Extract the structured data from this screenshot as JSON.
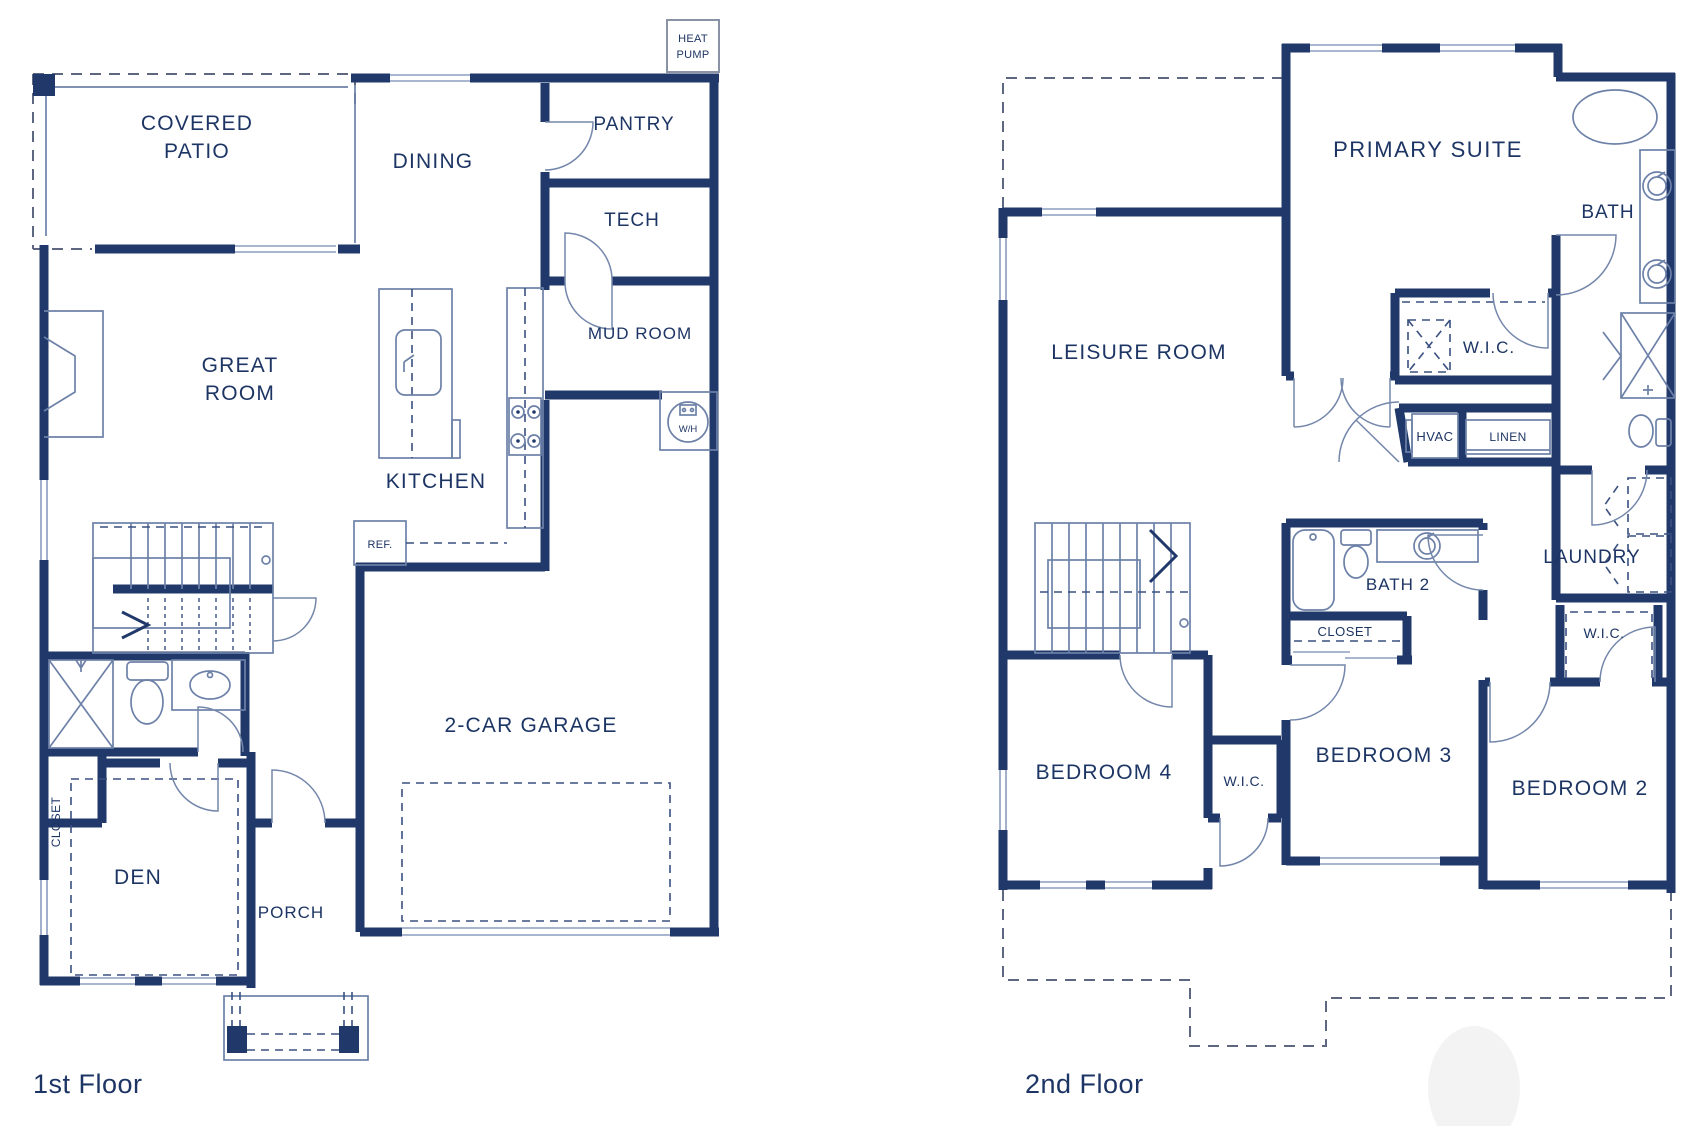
{
  "colors": {
    "wall": "#21396a",
    "text": "#1d3564",
    "thin_line": "#6d81a8",
    "window_line": "#8b9dc0",
    "dashed_outline": "#5d6880",
    "background": "#ffffff"
  },
  "floor1": {
    "name": "1st Floor",
    "rooms": {
      "covered_patio_1": "COVERED",
      "covered_patio_2": "PATIO",
      "dining": "DINING",
      "pantry": "PANTRY",
      "tech": "TECH",
      "mud_room": "MUD ROOM",
      "great_room_1": "GREAT",
      "great_room_2": "ROOM",
      "kitchen": "KITCHEN",
      "garage": "2-CAR GARAGE",
      "den": "DEN",
      "porch": "PORCH",
      "closet": "CLOSET"
    },
    "equipment": {
      "heat_pump_1": "HEAT",
      "heat_pump_2": "PUMP",
      "ref": "REF.",
      "water_heater": "W/H"
    }
  },
  "floor2": {
    "name": "2nd Floor",
    "rooms": {
      "primary_suite": "PRIMARY SUITE",
      "bath": "BATH",
      "leisure_room": "LEISURE ROOM",
      "wic_primary": "W.I.C.",
      "hvac": "HVAC",
      "linen": "LINEN",
      "laundry": "LAUNDRY",
      "bath2": "BATH 2",
      "closet": "CLOSET",
      "wic_bedroom2": "W.I.C.",
      "bedroom4": "BEDROOM 4",
      "wic_bedroom4": "W.I.C.",
      "bedroom3": "BEDROOM 3",
      "bedroom2": "BEDROOM 2"
    }
  }
}
